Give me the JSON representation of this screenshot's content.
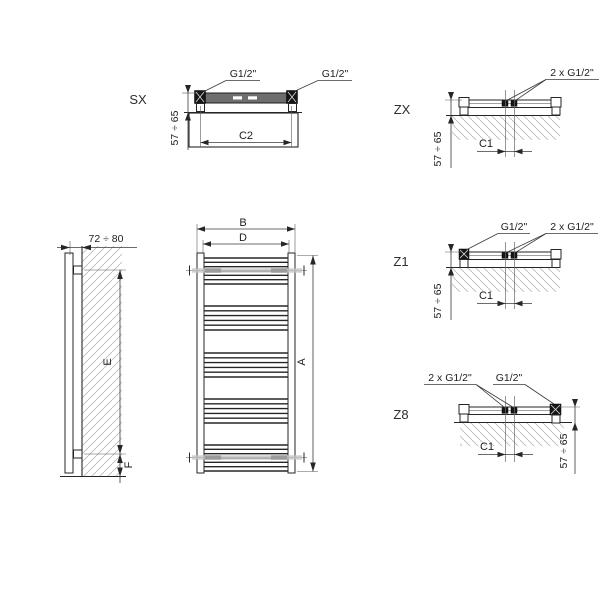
{
  "diagram": {
    "title": "towel-radiator-dimension-drawing",
    "views": {
      "sx": {
        "label": "SX",
        "port_left": "G1/2\"",
        "port_right": "G1/2\"",
        "depth": "57 ÷ 65",
        "width": "C2"
      },
      "zx": {
        "label": "ZX",
        "ports_center": "2 x G1/2\"",
        "depth": "57 ÷ 65",
        "center_distance": "C1"
      },
      "z1": {
        "label": "Z1",
        "port_side": "G1/2\"",
        "ports_center": "2 x G1/2\"",
        "depth": "57 ÷ 65",
        "center_distance": "C1"
      },
      "z8": {
        "label": "Z8",
        "ports_center": "2 x G1/2\"",
        "port_side": "G1/2\"",
        "depth": "57 ÷ 65",
        "center_distance": "C1"
      },
      "side": {
        "wall_distance": "72 ÷ 80",
        "bracket_span": "E",
        "bottom_offset": "F"
      },
      "front": {
        "height": "A",
        "overall_width": "B",
        "connection_spacing": "D"
      }
    },
    "colors": {
      "line": "#262626",
      "hatch": "#bdbdbd",
      "bar_fill": "#6e6e6e",
      "bracket": "#9b9b9b"
    }
  }
}
